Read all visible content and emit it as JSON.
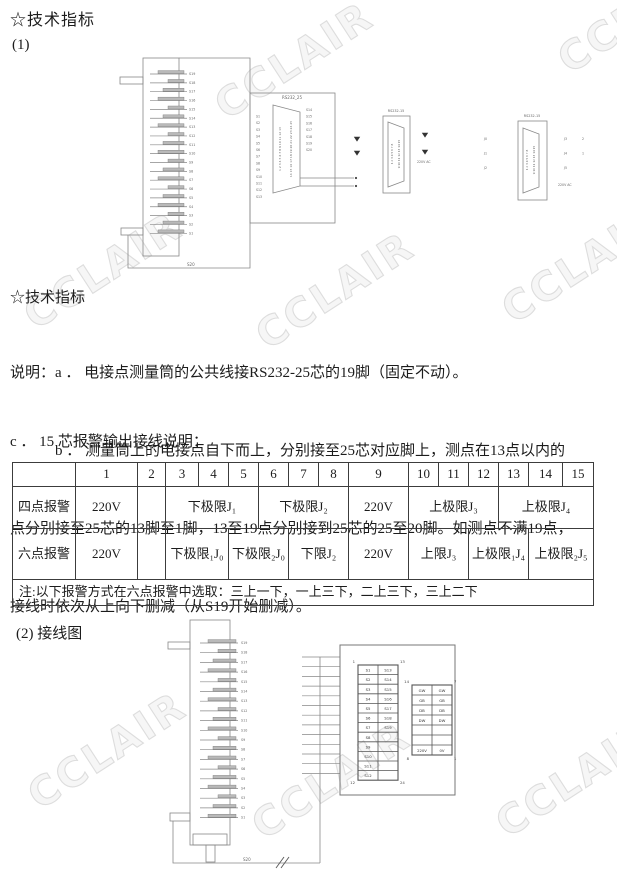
{
  "page": {
    "watermark": "CCLAIR",
    "title_top": "☆技术指标",
    "item1_label": "(1)",
    "section2_title": "☆技术指标",
    "note_lines": [
      "说明：a ． 电接点测量筒的公共线接RS232-25芯的19脚（固定不动）。",
      "　　　b ． 测量筒上的电接点自下而上，分别接至25芯对应脚上，测点在13点以内的",
      "点分别接至25芯的13脚至1脚，13至19点分别接到25芯的25至20脚。如测点不满19点，",
      "接线时依次从上向下删减（从S19开始删减）。"
    ],
    "section_c_title": "c ． 15 芯报警输出接线说明：",
    "item2_label": "(2) 接线图"
  },
  "table": {
    "header": [
      "",
      "1",
      "2",
      "3",
      "4",
      "5",
      "6",
      "7",
      "8",
      "9",
      "10",
      "11",
      "12",
      "13",
      "14",
      "15"
    ],
    "row_four": {
      "label": "四点报警",
      "cells": [
        "220V",
        "",
        "下极限J₁",
        "下极限J₂",
        "220V",
        "上极限J₃",
        "上极限J₄"
      ]
    },
    "row_six": {
      "label": "六点报警",
      "cells": [
        "220V",
        "",
        "下极限₁J₀",
        "下极限₂J₀",
        "下限J₂",
        "220V",
        "上限J₃",
        "上极限₁J₄",
        "上极限₂J₅"
      ]
    },
    "note": "注:以下报警方式在六点报警中选取：三上一下，一上三下，二上三下，三上二下"
  },
  "diagram1": {
    "cylinder_pins": [
      "S19",
      "S18",
      "S17",
      "S16",
      "S15",
      "S14",
      "S13",
      "S12",
      "S11",
      "S10",
      "S9",
      "S8",
      "S7",
      "S6",
      "S5",
      "S4",
      "S3",
      "S2",
      "S1"
    ],
    "cylinder_common": "S20",
    "db25": {
      "title": "RS232_25",
      "pin_row1": "1 2 3 4 5 6 7 8 9 10 11 12 13",
      "pin_row2": "14 15 16 17 18 19 20 21 22 23 24 25",
      "left_labels": [
        "S1",
        "S2",
        "S3",
        "S4",
        "S5",
        "S6",
        "S7",
        "S8",
        "S9",
        "S10",
        "S11",
        "S12",
        "S13"
      ],
      "right_labels": [
        "S14",
        "S15",
        "S16",
        "S17",
        "S18",
        "S19",
        "S20"
      ]
    },
    "db15_mid": {
      "title": "RS232-15",
      "pin_row1": "1 2 3 4 5 6 7 8",
      "pin_row2": "9 10 11 12 13 14 15",
      "supply_label": "220V AC"
    },
    "db15_right": {
      "title": "RS232-15",
      "pin_row1": "1 2 3 4 5 6 7 8",
      "pin_row2": "9 10 11 12 13 14 15",
      "left_labels": [
        "J0",
        "J1",
        "J2"
      ],
      "right_labels": [
        "J3",
        "J4",
        "J5"
      ],
      "right_nums": [
        "2",
        "1"
      ],
      "supply_label": "220V AC"
    }
  },
  "diagram2": {
    "cylinder_pins": [
      "S19",
      "S18",
      "S17",
      "S16",
      "S15",
      "S14",
      "S13",
      "S12",
      "S11",
      "S10",
      "S9",
      "S8",
      "S7",
      "S6",
      "S5",
      "S4",
      "S3",
      "S2",
      "S1"
    ],
    "cylinder_common": "S20",
    "block_a": {
      "corner_tl": "1",
      "corner_tr": "13",
      "corner_bl": "12",
      "corner_br": "24",
      "col1": [
        "S1",
        "S2",
        "S3",
        "S4",
        "S5",
        "S6",
        "S7",
        "S8",
        "S9",
        "S10",
        "S11",
        "S12"
      ],
      "col2": [
        "S13",
        "S14",
        "S15",
        "S16",
        "S17",
        "S18",
        "S19",
        "",
        "",
        "",
        "",
        ""
      ]
    },
    "block_b": {
      "corner_tl": "14",
      "corner_tr": "7",
      "corner_bl": "8",
      "corner_br": "1",
      "rows": [
        [
          "GW",
          "GW"
        ],
        [
          "GB",
          "GB"
        ],
        [
          "DB",
          "DB"
        ],
        [
          "DW",
          "DW"
        ],
        [
          "",
          ""
        ],
        [
          "",
          ""
        ],
        [
          "220V",
          "0V"
        ]
      ]
    }
  }
}
